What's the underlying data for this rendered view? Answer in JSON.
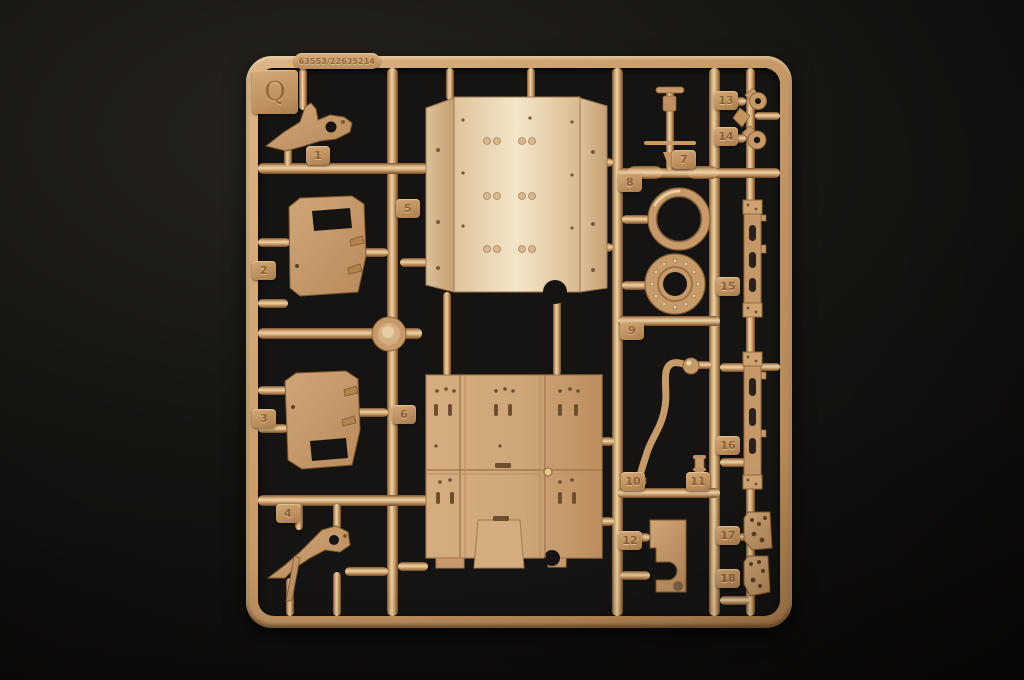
{
  "scene": {
    "subject": "tan plastic model-kit sprue photographed on black background",
    "plastic_color": "#c79a6a",
    "light_part_color": "#ecd8ba",
    "background_color": "#161412"
  },
  "sprue": {
    "letter": "Q",
    "mold_code": "63553/22635214",
    "part_count": "18"
  },
  "parts": [
    {
      "number": "1",
      "desc": "angled bracket"
    },
    {
      "number": "2",
      "desc": "door panel, upper window"
    },
    {
      "number": "3",
      "desc": "door panel, lower window"
    },
    {
      "number": "4",
      "desc": "angled bracket"
    },
    {
      "number": "5",
      "desc": "curved roof panel"
    },
    {
      "number": "6",
      "desc": "flat floor panel"
    },
    {
      "number": "7",
      "desc": "antenna mast"
    },
    {
      "number": "8",
      "desc": "smooth ring"
    },
    {
      "number": "9",
      "desc": "bolted ring"
    },
    {
      "number": "10",
      "desc": "bent tube"
    },
    {
      "number": "11",
      "desc": "small fitting"
    },
    {
      "number": "12",
      "desc": "stepped bracket"
    },
    {
      "number": "13",
      "desc": "towing hook"
    },
    {
      "number": "14",
      "desc": "towing hook"
    },
    {
      "number": "15",
      "desc": "rail"
    },
    {
      "number": "16",
      "desc": "rail"
    },
    {
      "number": "17",
      "desc": "hinge plate"
    },
    {
      "number": "18",
      "desc": "hinge plate"
    }
  ]
}
